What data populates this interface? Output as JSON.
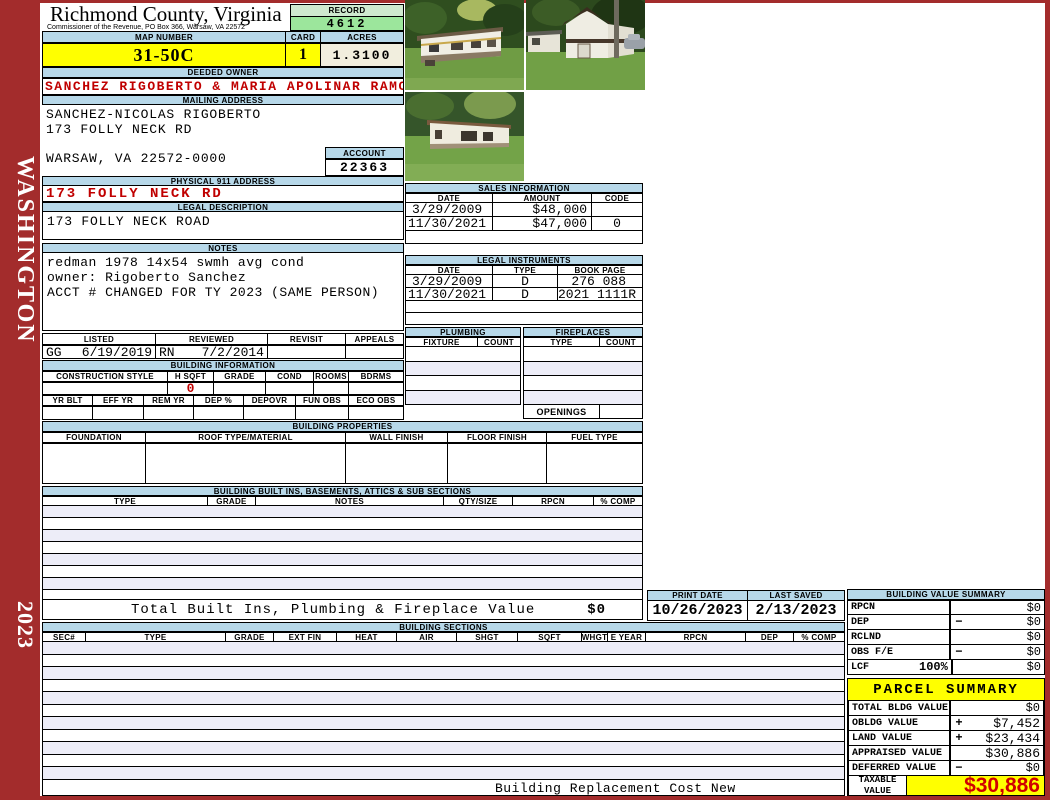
{
  "sidebar": {
    "district": "WASHINGTON",
    "year": "2023"
  },
  "header": {
    "county": "Richmond County, Virginia",
    "commissioner": "Commissioner of the Revenue, PO Box 366, Warsaw, VA 22572",
    "record_label": "RECORD",
    "record": "4612",
    "map_number_label": "MAP NUMBER",
    "map_number": "31-50C",
    "card_label": "CARD",
    "card": "1",
    "acres_label": "ACRES",
    "acres": "1.3100"
  },
  "owner": {
    "deeded_owner_label": "DEEDED OWNER",
    "deeded_owner": "SANCHEZ RIGOBERTO & MARIA APOLINAR RAMOS AN",
    "mailing_address_label": "MAILING ADDRESS",
    "mailing_line1": "SANCHEZ-NICOLAS RIGOBERTO",
    "mailing_line2": "173 FOLLY NECK RD",
    "mailing_line3": "WARSAW, VA 22572-0000",
    "account_label": "ACCOUNT",
    "account": "22363",
    "physical_address_label": "PHYSICAL 911 ADDRESS",
    "physical_address": "173 FOLLY NECK RD",
    "legal_description_label": "LEGAL DESCRIPTION",
    "legal_description": "173 FOLLY NECK ROAD"
  },
  "notes": {
    "label": "NOTES",
    "line1": "redman 1978 14x54 swmh avg cond",
    "line2": "owner: Rigoberto Sanchez",
    "line3": "ACCT # CHANGED FOR TY 2023 (SAME PERSON)"
  },
  "visits": {
    "headers": [
      "LISTED",
      "REVIEWED",
      "REVISIT",
      "APPEALS"
    ],
    "listed_by": "GG",
    "listed_date": "6/19/2019",
    "reviewed_by": "RN",
    "reviewed_date": "7/2/2014",
    "revisit": "",
    "appeals": ""
  },
  "building_information": {
    "label": "BUILDING INFORMATION",
    "row1_headers": [
      "CONSTRUCTION STYLE",
      "H SQFT",
      "GRADE",
      "COND",
      "ROOMS",
      "BDRMS"
    ],
    "h_sqft": "0",
    "row2_headers": [
      "YR BLT",
      "EFF YR",
      "REM YR",
      "DEP %",
      "DEPOVR",
      "FUN OBS",
      "ECO OBS"
    ]
  },
  "building_properties": {
    "label": "BUILDING PROPERTIES",
    "headers": [
      "FOUNDATION",
      "ROOF TYPE/MATERIAL",
      "WALL FINISH",
      "FLOOR FINISH",
      "FUEL TYPE"
    ]
  },
  "built_ins": {
    "label": "BUILDING BUILT INS, BASEMENTS, ATTICS & SUB SECTIONS",
    "headers": [
      "TYPE",
      "GRADE",
      "NOTES",
      "QTY/SIZE",
      "RPCN",
      "% COMP"
    ],
    "total_label": "Total Built Ins, Plumbing & Fireplace Value",
    "total_value": "$0"
  },
  "sales": {
    "label": "SALES INFORMATION",
    "headers": [
      "DATE",
      "AMOUNT",
      "CODE"
    ],
    "rows": [
      {
        "date": "3/29/2009",
        "amount": "$48,000",
        "code": ""
      },
      {
        "date": "11/30/2021",
        "amount": "$47,000",
        "code": "0"
      }
    ]
  },
  "legal_instruments": {
    "label": "LEGAL INSTRUMENTS",
    "headers": [
      "DATE",
      "TYPE",
      "BOOK PAGE"
    ],
    "rows": [
      {
        "date": "3/29/2009",
        "type": "D",
        "book_page": "276 088"
      },
      {
        "date": "11/30/2021",
        "type": "D",
        "book_page": "2021 1111R"
      }
    ]
  },
  "plumbing": {
    "label": "PLUMBING",
    "headers": [
      "FIXTURE",
      "COUNT"
    ]
  },
  "fireplaces": {
    "label": "FIREPLACES",
    "headers": [
      "TYPE",
      "COUNT"
    ],
    "openings_label": "OPENINGS"
  },
  "print_info": {
    "print_date_label": "PRINT DATE",
    "print_date": "10/26/2023",
    "last_saved_label": "LAST SAVED",
    "last_saved": "2/13/2023"
  },
  "building_sections": {
    "label": "BUILDING SECTIONS",
    "headers": [
      "SEC#",
      "TYPE",
      "GRADE",
      "EXT FIN",
      "HEAT",
      "AIR",
      "SHGT",
      "SQFT",
      "WHGT",
      "E YEAR",
      "RPCN",
      "DEP",
      "% COMP"
    ],
    "footer": "Building Replacement Cost New"
  },
  "building_value_summary": {
    "label": "BUILDING VALUE SUMMARY",
    "rows": [
      {
        "label": "RPCN",
        "op": "",
        "value": "$0"
      },
      {
        "label": "DEP",
        "op": "−",
        "value": "$0"
      },
      {
        "label": "RCLND",
        "op": "",
        "value": "$0"
      },
      {
        "label": "OBS F/E",
        "op": "−",
        "value": "$0"
      },
      {
        "label": "LCF",
        "pct": "100%",
        "op": "",
        "value": "$0"
      }
    ]
  },
  "parcel_summary": {
    "label": "PARCEL SUMMARY",
    "rows": [
      {
        "label": "TOTAL BLDG VALUE",
        "op": "",
        "value": "$0"
      },
      {
        "label": "OBLDG VALUE",
        "op": "+",
        "value": "$7,452"
      },
      {
        "label": "LAND VALUE",
        "op": "+",
        "value": "$23,434"
      },
      {
        "label": "APPRAISED VALUE",
        "op": "",
        "value": "$30,886"
      },
      {
        "label": "DEFERRED VALUE",
        "op": "−",
        "value": "$0"
      }
    ],
    "taxable_label_line1": "TAXABLE",
    "taxable_label_line2": "VALUE",
    "taxable_value": "$30,886"
  },
  "colors": {
    "sidebar_red": "#a32c2c",
    "header_blue": "#b7d8e9",
    "record_green": "#9ce69c",
    "highlight_yellow": "#ffff00",
    "alert_red": "#c00000"
  }
}
